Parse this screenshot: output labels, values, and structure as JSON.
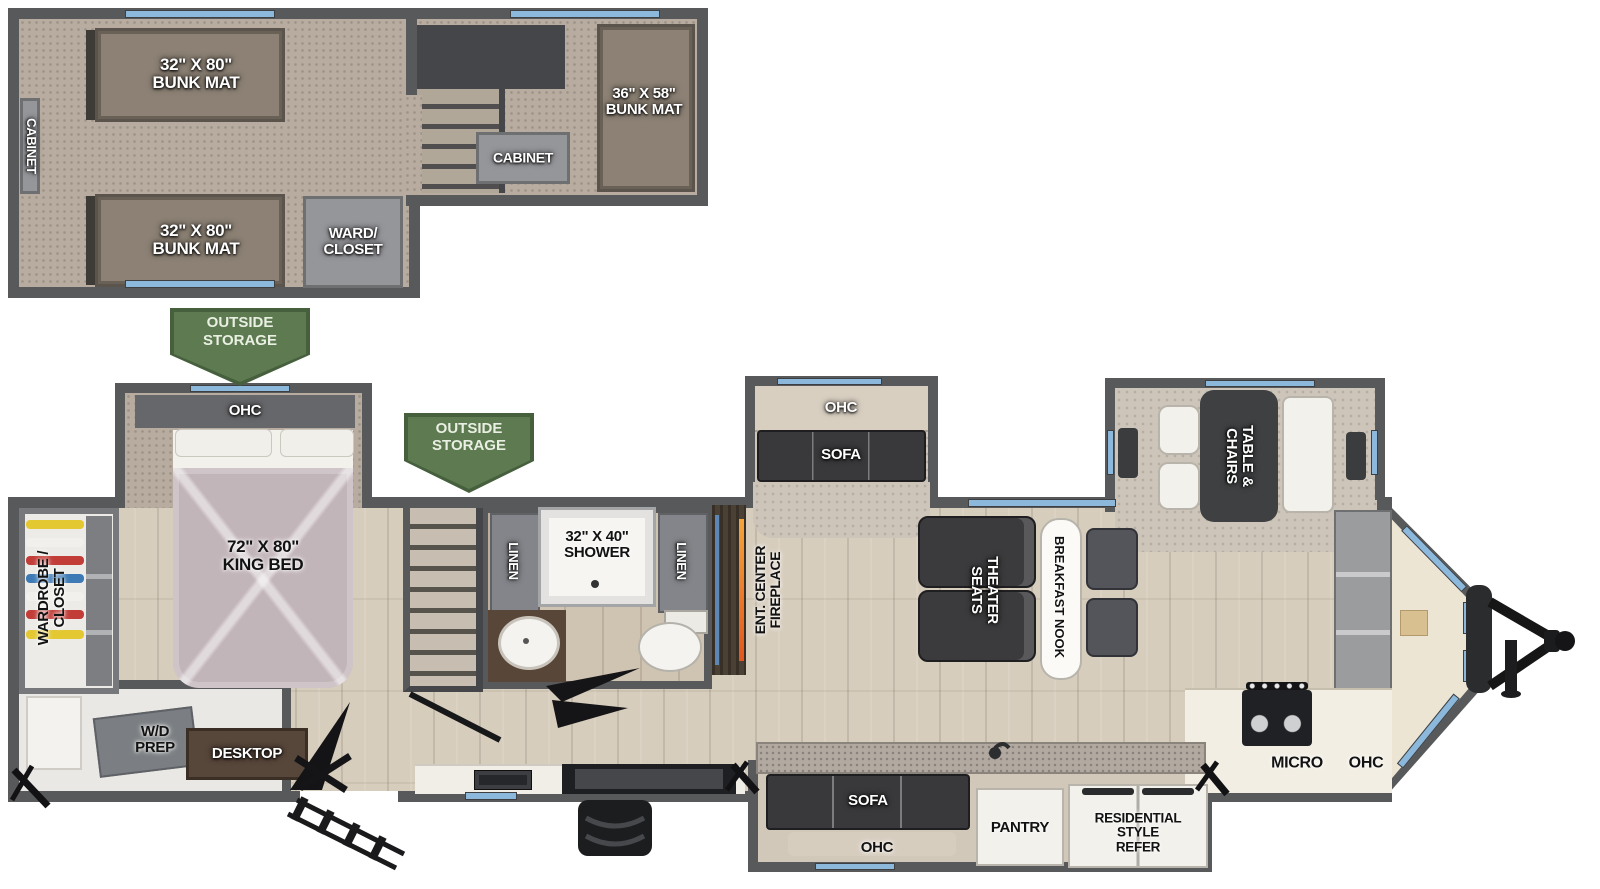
{
  "loft": {
    "side_cabinet": "CABINET",
    "bunk_top": "32\" X 80\"\nBUNK MAT",
    "bunk_bottom": "32\" X 80\"\nBUNK MAT",
    "ward_closet": "WARD/\nCLOSET",
    "center_cabinet": "CABINET",
    "bunk_front": "36\" X 58\"\nBUNK MAT"
  },
  "storage": {
    "rear_badge": "OUTSIDE\nSTORAGE",
    "mid_badge": "OUTSIDE\nSTORAGE"
  },
  "bedroom": {
    "ohc": "OHC",
    "king_bed": "72\" X 80\"\nKING BED",
    "wardrobe": "WARDROBE /\nCLOSET",
    "wd_prep": "W/D\nPREP",
    "desktop": "DESKTOP"
  },
  "bathroom": {
    "linen_left": "LINEN",
    "shower": "32\" X 40\"\nSHOWER",
    "linen_right": "LINEN"
  },
  "living": {
    "fireplace": "ENT. CENTER\nFIREPLACE",
    "ohc": "OHC",
    "sofa": "SOFA",
    "theater": "THEATER\nSEATS",
    "breakfast_nook": "BREAKFAST NOOK",
    "table_chairs": "TABLE &\nCHAIRS"
  },
  "kitchen": {
    "micro": "MICRO",
    "ohc": "OHC",
    "island_sofa": "SOFA",
    "island_ohc": "OHC",
    "pantry": "PANTRY",
    "refer": "RESIDENTIAL\nSTYLE\nREFER"
  },
  "colors": {
    "wall": "#58595b",
    "window": "#8cb8dc",
    "storage_badge": "#5d7a50",
    "wood_floor": "#d7cdbd",
    "carpet": "#b7ac9f",
    "flame": "#e8722a",
    "bed_quilt": "#c2b5b9"
  }
}
